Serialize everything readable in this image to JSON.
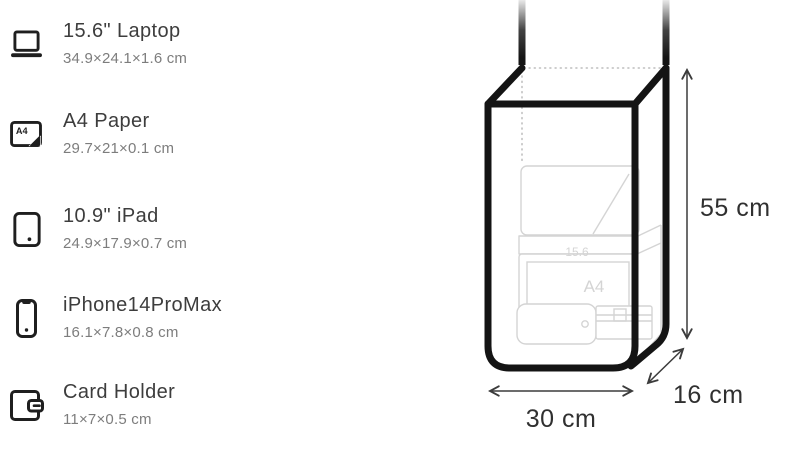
{
  "comparison_list": {
    "items": [
      {
        "title": "15.6\" Laptop",
        "dimensions": "34.9×24.1×1.6 cm",
        "icon": "laptop-icon"
      },
      {
        "title": "A4 Paper",
        "dimensions": "29.7×21×0.1 cm",
        "icon": "a4-paper-icon"
      },
      {
        "title": "10.9\" iPad",
        "dimensions": "24.9×17.9×0.7 cm",
        "icon": "tablet-icon"
      },
      {
        "title": "iPhone14ProMax",
        "dimensions": "16.1×7.8×0.8 cm",
        "icon": "phone-icon"
      },
      {
        "title": "Card Holder",
        "dimensions": "11×7×0.5 cm",
        "icon": "wallet-icon"
      }
    ],
    "a4_icon_label": "A4"
  },
  "bag_diagram": {
    "height_label": "55 cm",
    "width_label": "30 cm",
    "depth_label": "16 cm",
    "ghost_labels": {
      "laptop": "15.6",
      "paper": "A4"
    }
  },
  "colors": {
    "outline": "#141414",
    "title-text": "#3d3d3d",
    "subtitle-text": "#7d7d7d",
    "dimension-text": "#303030",
    "ghost-line": "#d4d4d4",
    "dotted-line": "#c6c6c6",
    "icon-ink": "#1f1f1f"
  }
}
